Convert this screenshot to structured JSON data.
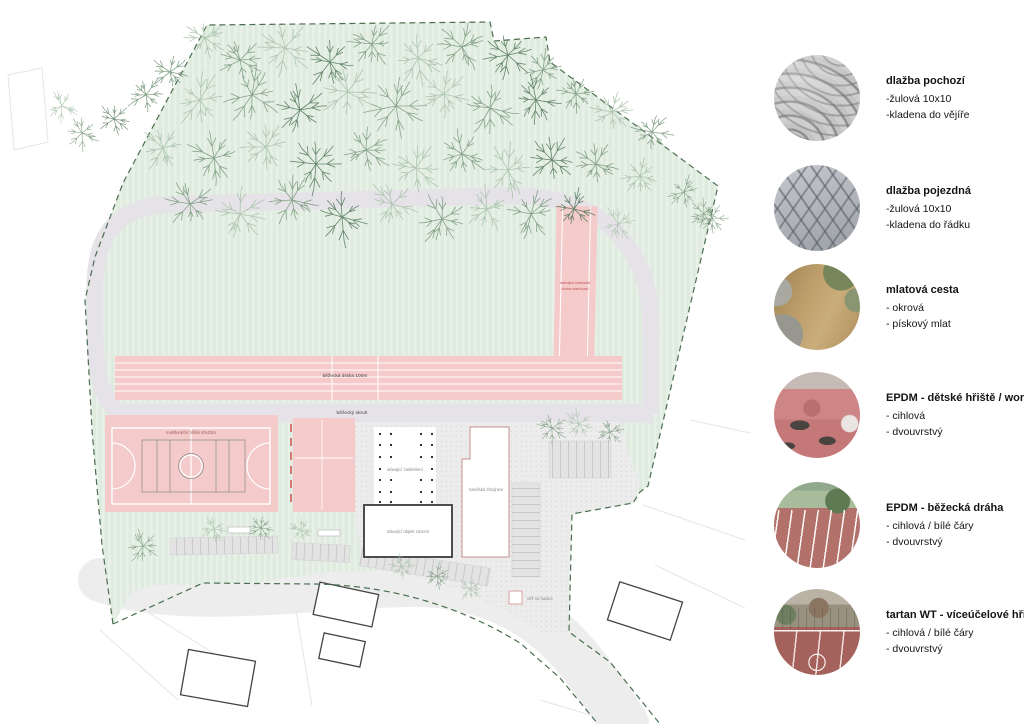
{
  "legend": {
    "items": [
      {
        "title": "dlažba pochozí",
        "lines": [
          "-žulová 10x10",
          "-kladena do vějíře"
        ],
        "swatch": "paving-fan"
      },
      {
        "title": "dlažba pojezdná",
        "lines": [
          "-žulová 10x10",
          "-kladena do řádku"
        ],
        "swatch": "paving-grid"
      },
      {
        "title": "mlatová cesta",
        "lines": [
          "- okrová",
          "- pískový mlat"
        ],
        "swatch": "dirt-path"
      },
      {
        "title": "EPDM - dětské hřiště / workout",
        "lines": [
          "- cihlová",
          "- dvouvrstvý"
        ],
        "swatch": "epdm-playground"
      },
      {
        "title": "EPDM - běžecká dráha",
        "lines": [
          "- cihlová / bílé čáry",
          "- dvouvrstvý"
        ],
        "swatch": "epdm-track"
      },
      {
        "title": "tartan WT - víceúčelové hřiště",
        "lines": [
          "- cihlová / bílé čáry",
          "- dvouvrstvý"
        ],
        "swatch": "tartan-court"
      }
    ]
  },
  "plan": {
    "labels": {
      "track_straight": "běžecká dráha 100m",
      "track_loop": "běžecký okruh",
      "multi_court": "multifunkční hřiště 40x20m",
      "fire_track_line1": "stávající hasičská",
      "fire_track_line2": "dráha startovací",
      "canopy": "stávající zastřešení",
      "fire_station": "hasičská zbrojnice",
      "facility_building": "stávající objekt zázemí",
      "hose_tower": "věž na hadice"
    },
    "colors": {
      "site_green": "#dfebdf",
      "track_pink": "#f4caca",
      "loop_gray": "#e5e2e8",
      "road_gray": "#ededed",
      "boundary_green": "#4a6e4e",
      "accent_red": "#d05050"
    }
  }
}
